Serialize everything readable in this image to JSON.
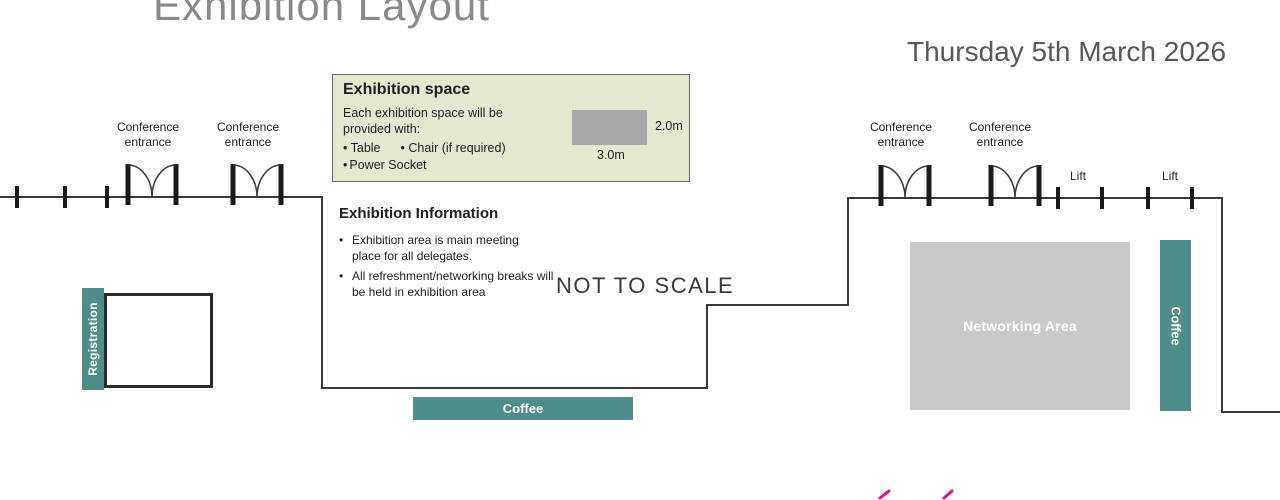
{
  "header": {
    "title": "Exhibition Layout",
    "date": "Thursday 5th March 2026"
  },
  "legend": {
    "title": "Exhibition space",
    "intro": "Each exhibition space will be provided with:",
    "items": [
      "Table",
      "Chair (if required)",
      "Power Socket"
    ],
    "space": {
      "width_label": "3.0m",
      "depth_label": "2.0m"
    }
  },
  "info": {
    "title": "Exhibition Information",
    "bullets": [
      "Exhibition area is main meeting place for all delegates.",
      "All refreshment/networking breaks will be held in exhibition area"
    ]
  },
  "annotations": {
    "not_to_scale": "NOT TO SCALE"
  },
  "labels": {
    "conference_entrance": "Conference entrance",
    "lift": "Lift"
  },
  "areas": {
    "registration": "Registration",
    "coffee_station": "Coffee",
    "networking": "Networking Area",
    "coffee_bar": "Coffee"
  },
  "colors": {
    "teal_accent": "#4f8d89",
    "legend_background": "#e2e9d0",
    "legend_swatch_gray": "#a8a8a8",
    "networking_gray": "#c9c9c9",
    "wall_line": "#3a3a3a",
    "title_gray": "#87898b",
    "pink_mark": "#e50a8e"
  }
}
